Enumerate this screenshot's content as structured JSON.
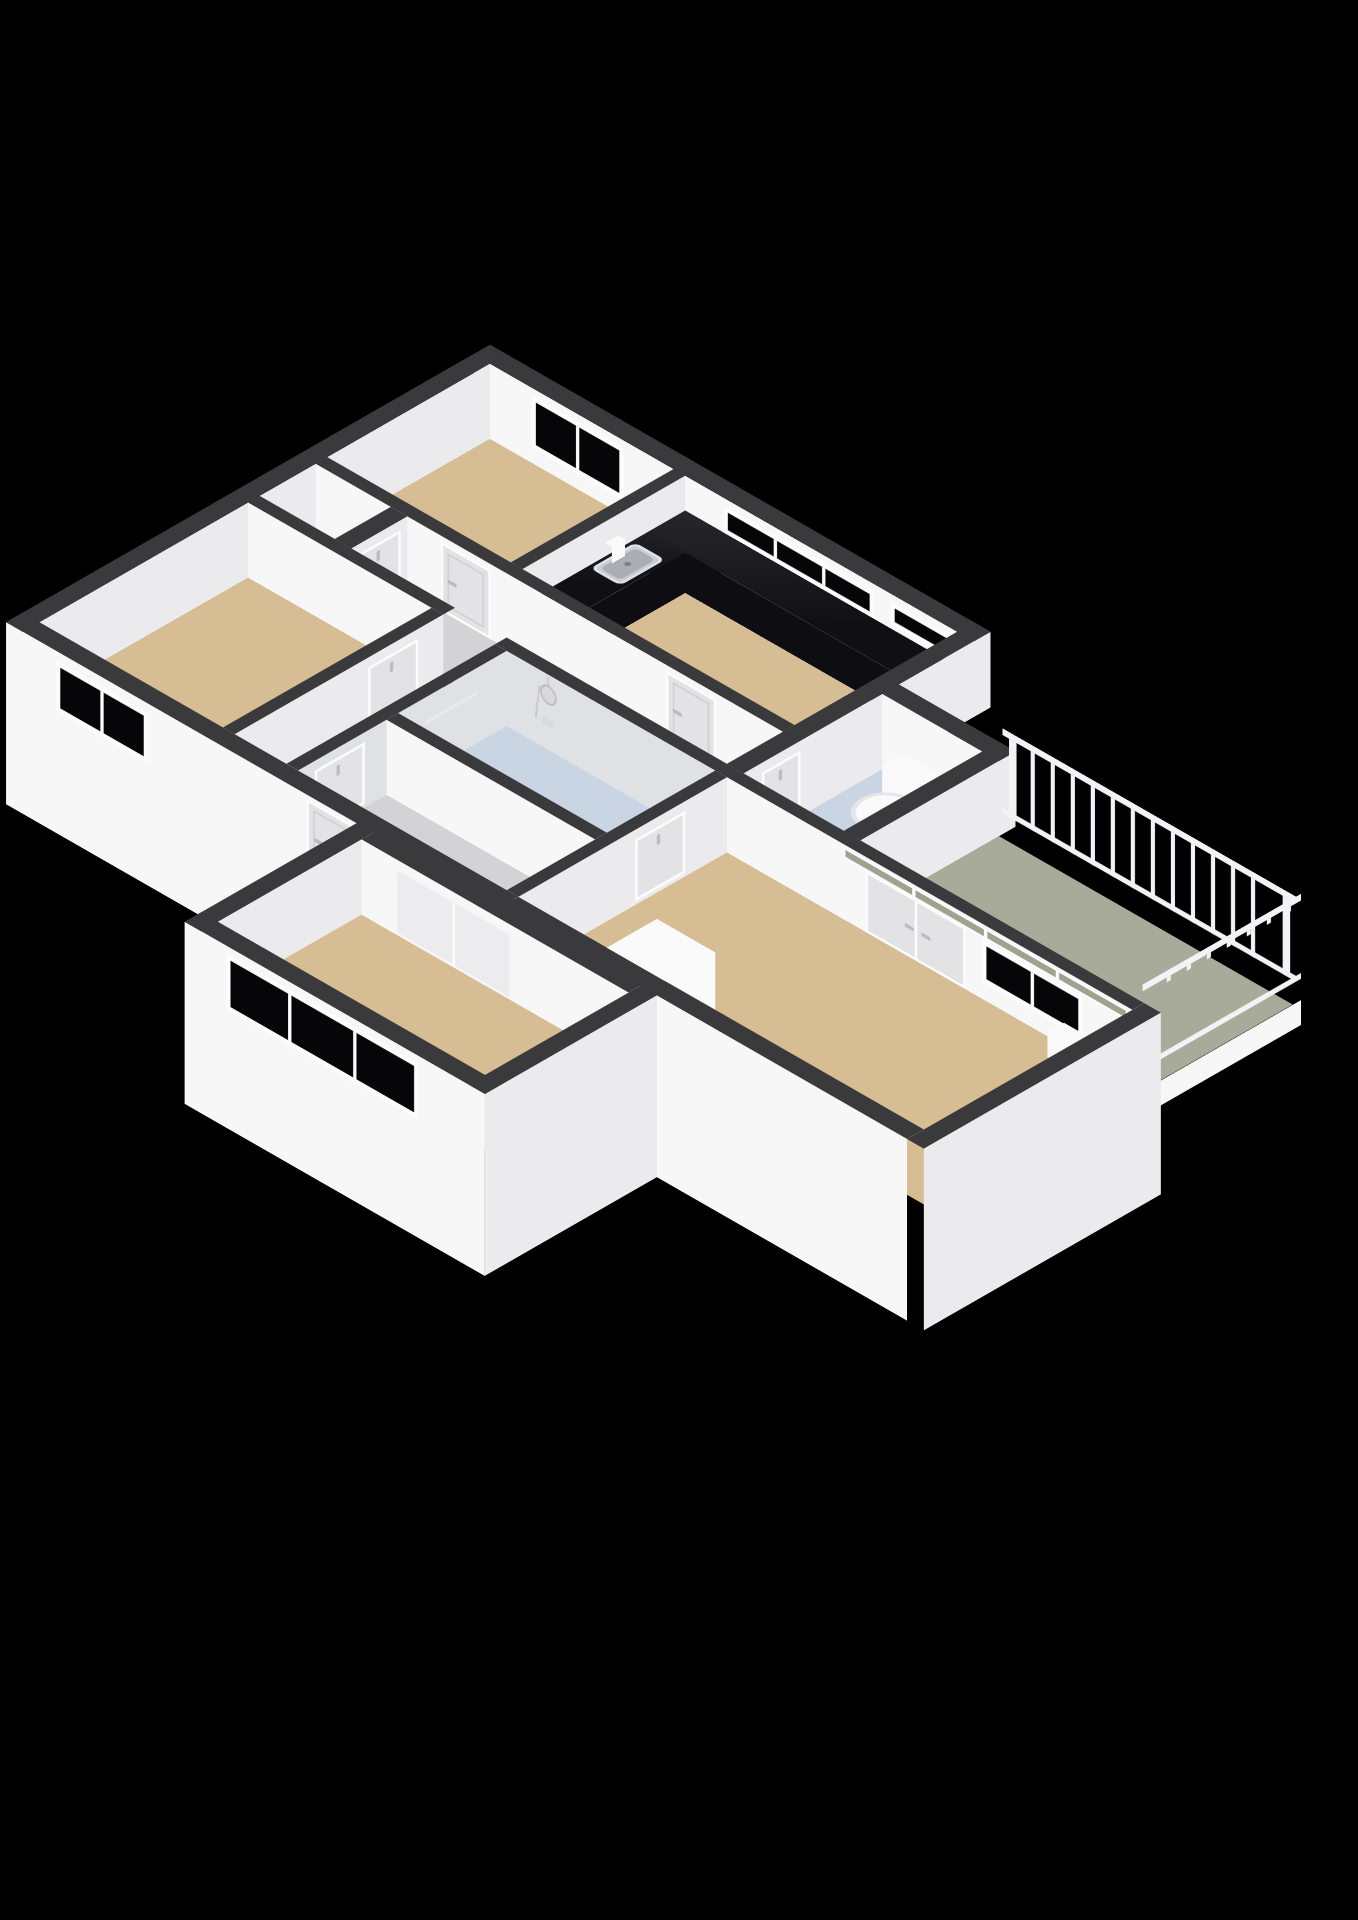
{
  "meta": {
    "title": "3D floor plan — isometric apartment render",
    "render_style": "isometric 3d floorplan on black background",
    "visible_text": "none"
  },
  "colors": {
    "bg": "#000000",
    "walltop": "#3a3a3c",
    "faces": "#f7f7f8",
    "facee": "#ebebee",
    "faceshade": "#e0e1e4",
    "floortan": "#d7bd93",
    "floorgray": "#d3d3d5",
    "floorblue": "#c9d5e3",
    "floorsage": "#a8ab99",
    "glass": "#060608",
    "glasssage": "#9fa28f",
    "frame": "#fcfcfd",
    "door": "#e3e3e6",
    "doorhandle": "#b9bcc1",
    "counter": "#17171c",
    "counterside": "#0e0e12",
    "steel": "#c9ccd2",
    "white": "#fafafa",
    "rail": "#f3f3f5"
  },
  "rooms": [
    {
      "id": "bedroom-top",
      "floor": "wood-tan",
      "features": [
        "window-ne",
        "door-to-corridor"
      ]
    },
    {
      "id": "kitchen",
      "floor": "wood-tan",
      "features": [
        "l-shaped-black-counter",
        "steel-sink",
        "faucet",
        "two-windows"
      ]
    },
    {
      "id": "closet",
      "floor": "gray",
      "features": [
        "door"
      ]
    },
    {
      "id": "corridor",
      "floor": "gray",
      "features": [
        "doors-both-sides"
      ]
    },
    {
      "id": "wc",
      "floor": "light-blue",
      "features": [
        "toilet",
        "door"
      ]
    },
    {
      "id": "bathroom",
      "floor": "light-blue",
      "features": [
        "shower-set",
        "mixer",
        "towel-rail"
      ]
    },
    {
      "id": "entrance-hall",
      "floor": "gray",
      "features": [
        "front-door"
      ]
    },
    {
      "id": "bedroom-left",
      "floor": "wood-tan",
      "features": [
        "window-sw",
        "door"
      ]
    },
    {
      "id": "living-room",
      "floor": "wood-tan",
      "features": [
        "double-doors-to-balcony",
        "transom-glass-band",
        "window",
        "column-block",
        "sill-block",
        "interior-door"
      ]
    },
    {
      "id": "bedroom-bottom",
      "floor": "wood-tan",
      "features": [
        "large-3-pane-window",
        "sliding-partition"
      ]
    },
    {
      "id": "balcony",
      "floor": "sage-green",
      "features": [
        "white-railing-ne",
        "white-railing-se",
        "slab-fascia"
      ]
    }
  ],
  "fixtures": [
    "kitchen-counter",
    "kitchen-sink",
    "faucet",
    "toilet",
    "shower-head",
    "shower-hose",
    "shower-mixer",
    "towel-rail",
    "balcony-railing"
  ],
  "railing": {
    "ne_balusters": 14,
    "se_balusters": 7,
    "bars": [
      "top-rail",
      "bottom-rail"
    ]
  },
  "openings": {
    "windows": 7,
    "doors": 9,
    "sliding_doors": 1
  }
}
